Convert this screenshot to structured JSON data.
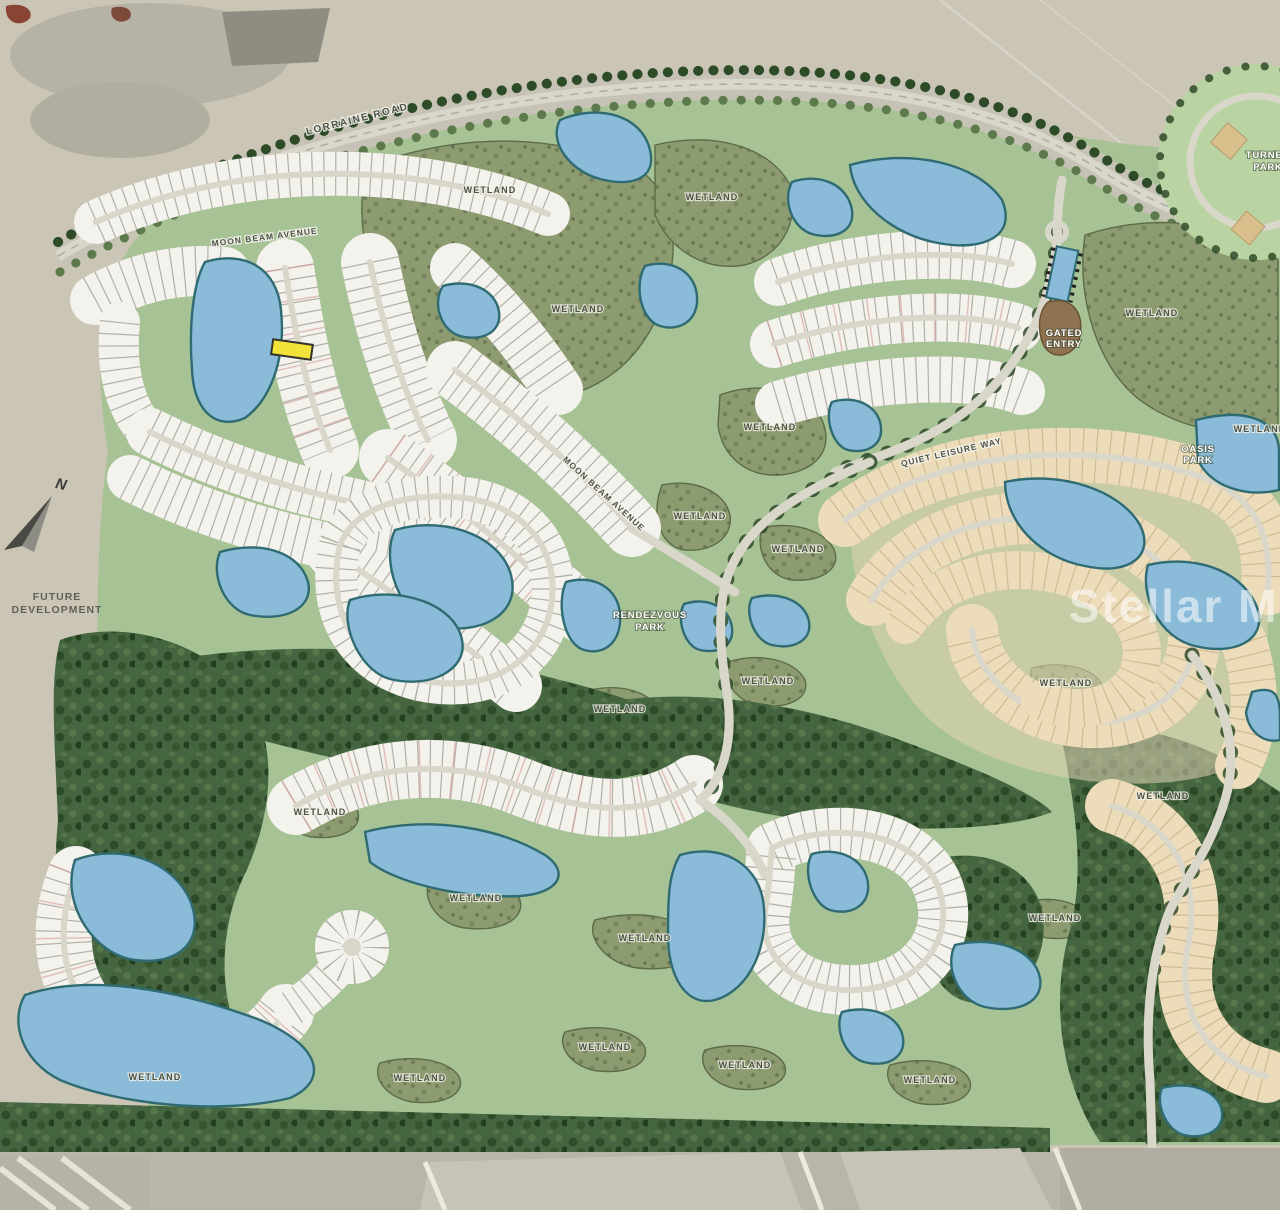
{
  "title": "Residential community master site plan map",
  "map": {
    "colors": {
      "background": "#cac5b4",
      "green": "#a7c295",
      "green_light": "#b9d4a2",
      "wetland": "#8d9b70",
      "forest": "#456540",
      "tree_dark": "#2e4b28",
      "lake": "#8abbd8",
      "lake_edge": "#2f6b72",
      "lots": "#f3f2ec",
      "lot_line": "#9a998f",
      "road": "#d9d6ca",
      "cream": "#ecdcba",
      "cream_line": "#bfa87f",
      "highlight": "#f2e23a",
      "watermark_text_color": "rgba(255,255,255,0.55)"
    },
    "wetland_label_text": "WETLAND",
    "wetland_positions": [
      [
        490,
        193
      ],
      [
        578,
        312
      ],
      [
        712,
        200
      ],
      [
        770,
        430
      ],
      [
        700,
        519
      ],
      [
        798,
        552
      ],
      [
        1152,
        316
      ],
      [
        1260,
        432
      ],
      [
        768,
        684
      ],
      [
        620,
        712
      ],
      [
        1066,
        686
      ],
      [
        1163,
        799
      ],
      [
        320,
        815
      ],
      [
        476,
        901
      ],
      [
        645,
        941
      ],
      [
        605,
        1050
      ],
      [
        745,
        1068
      ],
      [
        420,
        1081
      ],
      [
        155,
        1080
      ],
      [
        930,
        1083
      ],
      [
        1055,
        921
      ]
    ],
    "labels": [
      {
        "name": "lorraine-road-label",
        "text": "LORRAINE ROAD",
        "x": 358,
        "y": 122,
        "rot": -14,
        "cls": "road"
      },
      {
        "name": "moon-beam-avenue-label",
        "text": "MOON BEAM AVENUE",
        "x": 265,
        "y": 240,
        "rot": -7,
        "cls": "road small"
      },
      {
        "name": "moon-beam-avenue-label-2",
        "text": "MOON BEAM AVENUE",
        "x": 602,
        "y": 496,
        "rot": 42,
        "cls": "road small"
      },
      {
        "name": "quiet-leisure-way-label",
        "text": "QUIET LEISURE WAY",
        "x": 952,
        "y": 455,
        "rot": -13,
        "cls": "road small"
      },
      {
        "name": "future-development-label",
        "lines": [
          "FUTURE",
          "DEVELOPMENT"
        ],
        "x": 57,
        "y": 600,
        "lh": 13,
        "cls": "future"
      },
      {
        "name": "gated-entry-label",
        "lines": [
          "GATED",
          "ENTRY"
        ],
        "x": 1064,
        "y": 336,
        "lh": 11,
        "cls": "poi"
      },
      {
        "name": "rendezvous-park-label",
        "lines": [
          "RENDEZVOUS",
          "PARK"
        ],
        "x": 650,
        "y": 618,
        "lh": 12,
        "cls": "poi"
      },
      {
        "name": "turner-park-label",
        "lines": [
          "TURNER",
          "PARK"
        ],
        "x": 1268,
        "y": 158,
        "lh": 12,
        "cls": "poi"
      },
      {
        "name": "oasis-park-label",
        "lines": [
          "OASIS",
          "PARK"
        ],
        "x": 1198,
        "y": 452,
        "lh": 11,
        "cls": "poi"
      },
      {
        "name": "north-label",
        "text": "N",
        "x": 60,
        "y": 489,
        "rot": 12,
        "cls": "north"
      },
      {
        "name": "stellar-mls-watermark",
        "text": "Stellar MLS",
        "x": 1205,
        "y": 622,
        "cls": "watermark"
      }
    ]
  }
}
